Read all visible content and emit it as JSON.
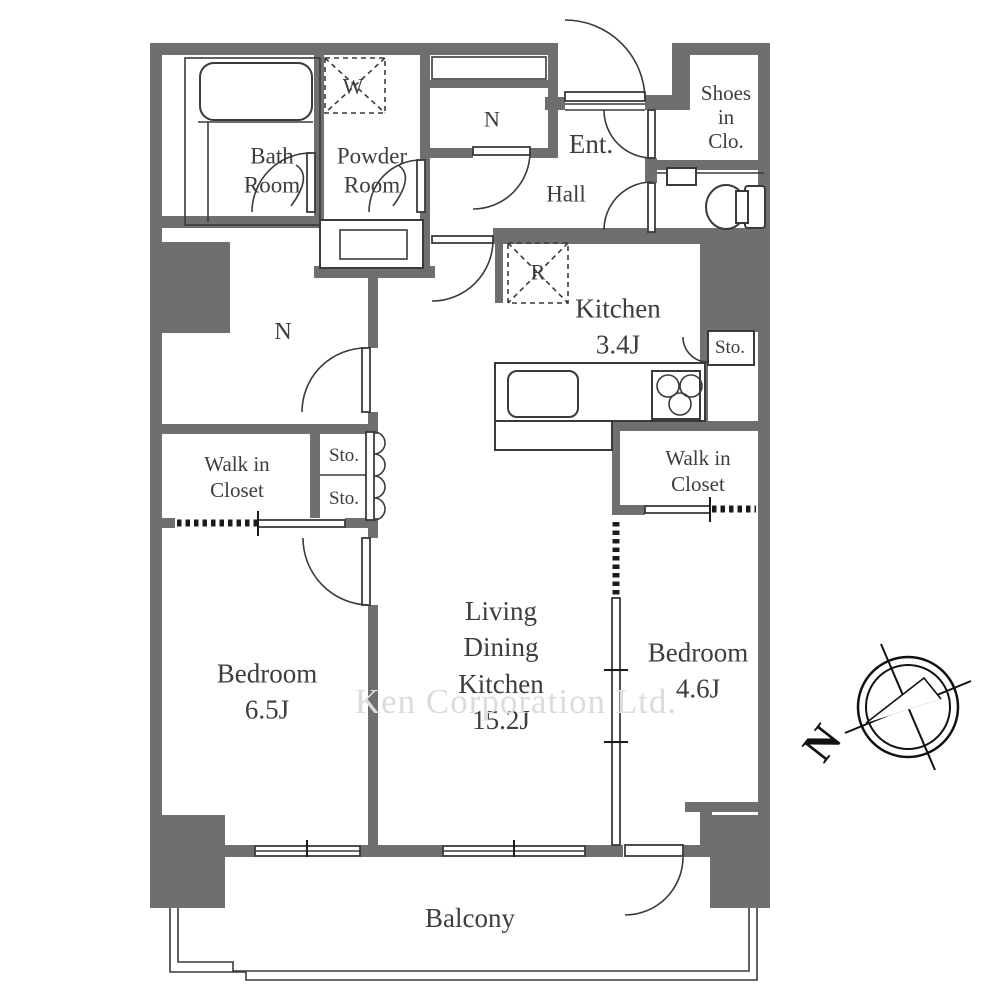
{
  "plan": {
    "watermark": "Ken Corporation Ltd.",
    "compass_label": "N",
    "rooms": {
      "bath": {
        "label": "Bath\nRoom"
      },
      "powder": {
        "label": "Powder\nRoom"
      },
      "closet_top": {
        "label": "N"
      },
      "entrance": {
        "label": "Ent."
      },
      "hall": {
        "label": "Hall"
      },
      "shoes_closet": {
        "label": "Shoes\nin\nClo."
      },
      "kitchen": {
        "label": "Kitchen\n3.4J"
      },
      "kitchen_storage": {
        "label": "Sto."
      },
      "storage_room": {
        "label": "N"
      },
      "wic_left": {
        "label": "Walk in\nCloset"
      },
      "sto_a": {
        "label": "Sto."
      },
      "sto_b": {
        "label": "Sto."
      },
      "wic_right": {
        "label": "Walk in\nCloset"
      },
      "bedroom_left": {
        "label": "Bedroom\n6.5J"
      },
      "ldk": {
        "label": "Living\nDining\nKitchen\n15.2J"
      },
      "bedroom_right": {
        "label": "Bedroom\n4.6J"
      },
      "balcony": {
        "label": "Balcony"
      }
    },
    "appliances": {
      "washer": "W",
      "fridge": "R"
    },
    "colors": {
      "wall": "#6f6f6f",
      "line": "#3a3a3a",
      "text": "#3d3d3d",
      "watermark": "#dcdcdc"
    }
  }
}
